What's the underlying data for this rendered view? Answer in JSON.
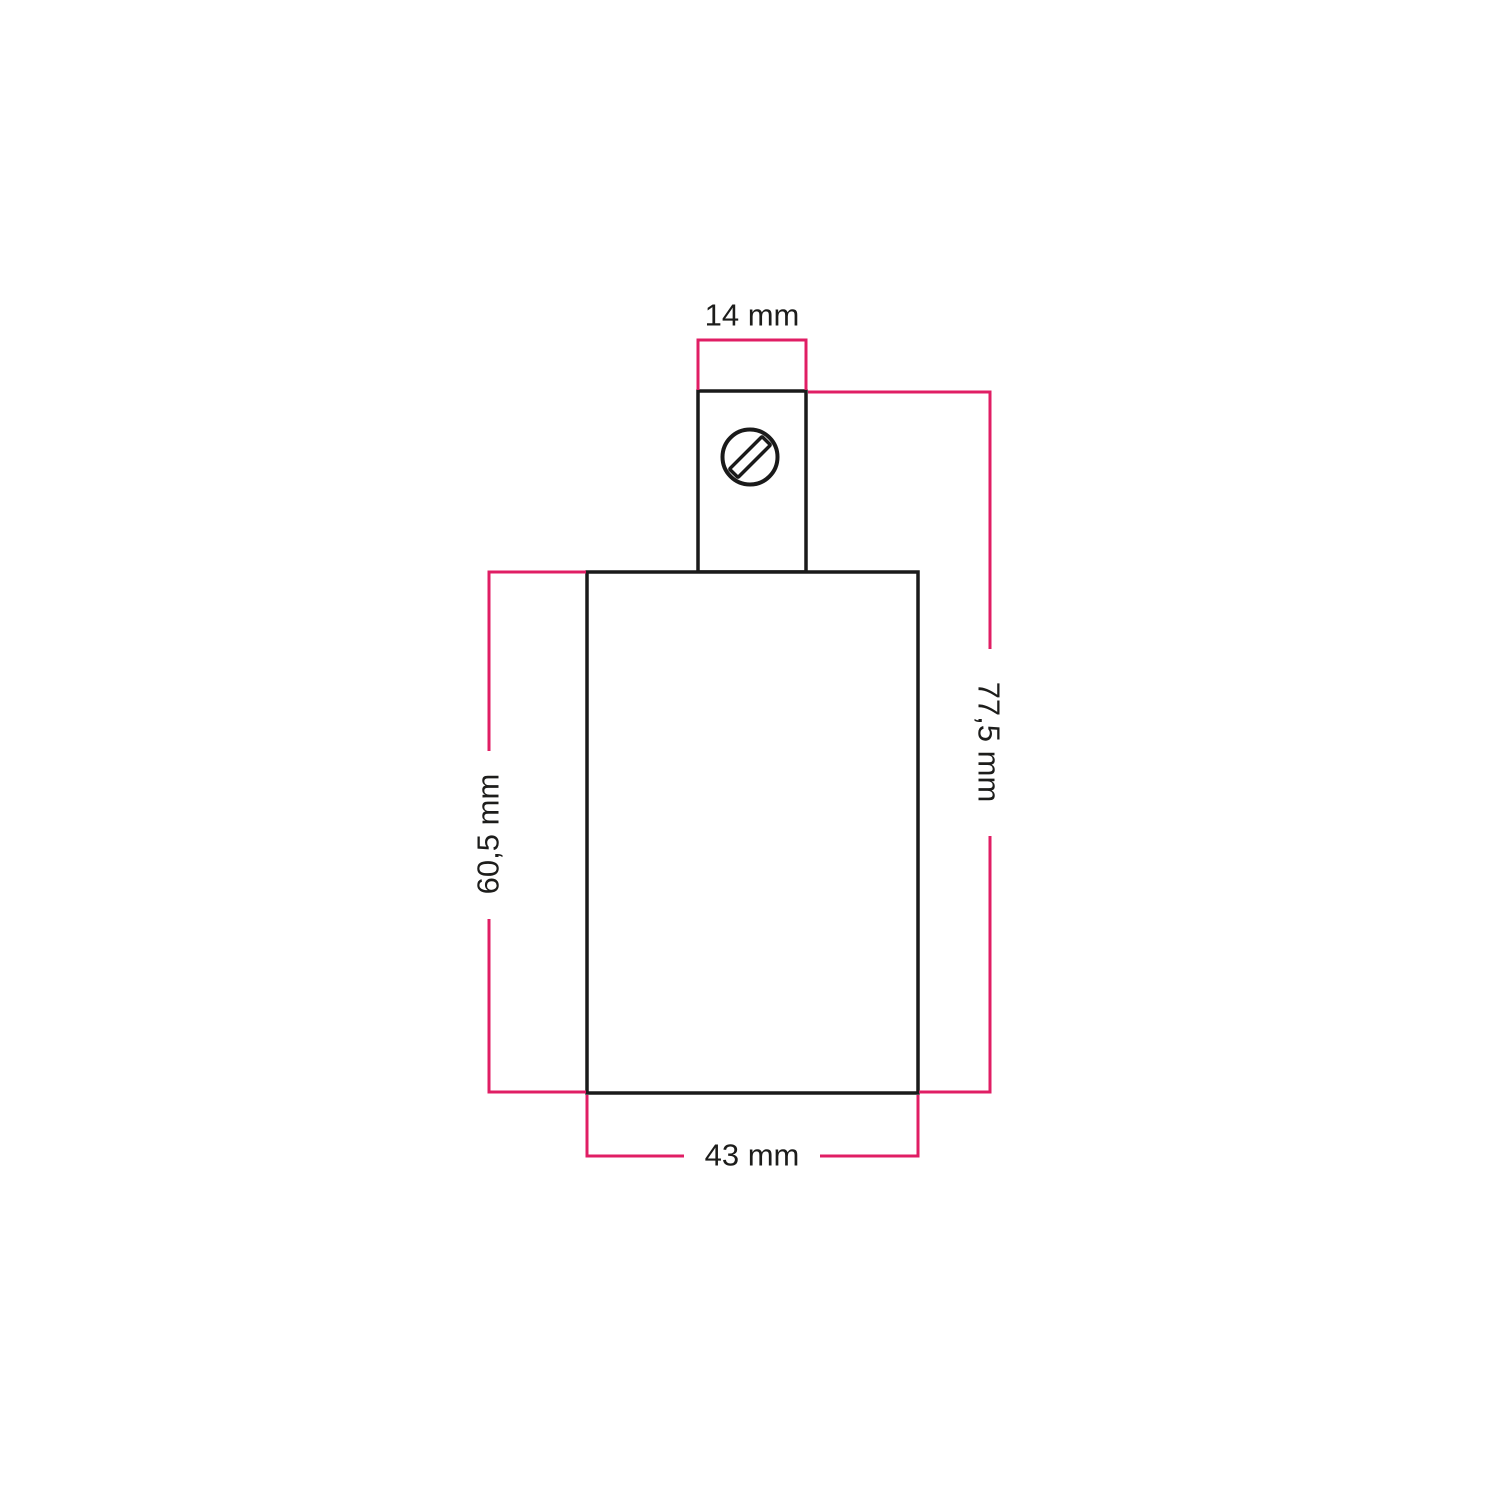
{
  "diagram": {
    "kind": "technical-dimension-drawing",
    "subject": "lamp-holder-with-cable-clamp",
    "colors": {
      "background": "#ffffff",
      "outline": "#1a1a1a",
      "dimension_line": "#e01e64",
      "label_text": "#1d1d1b"
    },
    "dimensions": {
      "clamp_width": {
        "label": "14 mm",
        "value_mm": 14,
        "position": "top"
      },
      "total_height": {
        "label": "77,5 mm",
        "value_mm": 77.5,
        "position": "right"
      },
      "body_height": {
        "label": "60,5 mm",
        "value_mm": 60.5,
        "position": "left"
      },
      "body_width": {
        "label": "43 mm",
        "value_mm": 43,
        "position": "bottom"
      }
    },
    "icons": [
      {
        "name": "screw-slot-icon",
        "meaning": "terminal screw with slotted head"
      }
    ]
  }
}
